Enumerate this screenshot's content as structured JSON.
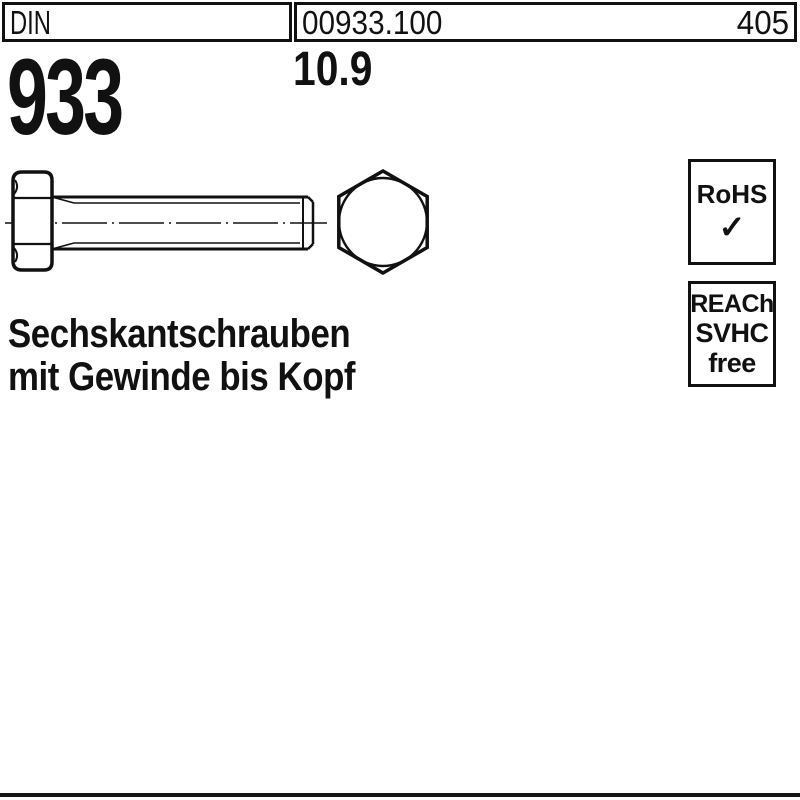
{
  "colors": {
    "ink": "#111111",
    "paper": "#ffffff"
  },
  "header": {
    "din_label": "DIN",
    "article_number": "00933.100",
    "catalog_page": "405"
  },
  "product": {
    "standard": "933",
    "strength_class": "10.9",
    "name_line1": "Sechskantschrauben",
    "name_line2": "mit Gewinde bis Kopf"
  },
  "compliance": {
    "rohs": {
      "label": "RoHS",
      "check_icon": "✓"
    },
    "reach": {
      "line1": "REACh",
      "line2": "SVHC",
      "line3": "free"
    }
  }
}
